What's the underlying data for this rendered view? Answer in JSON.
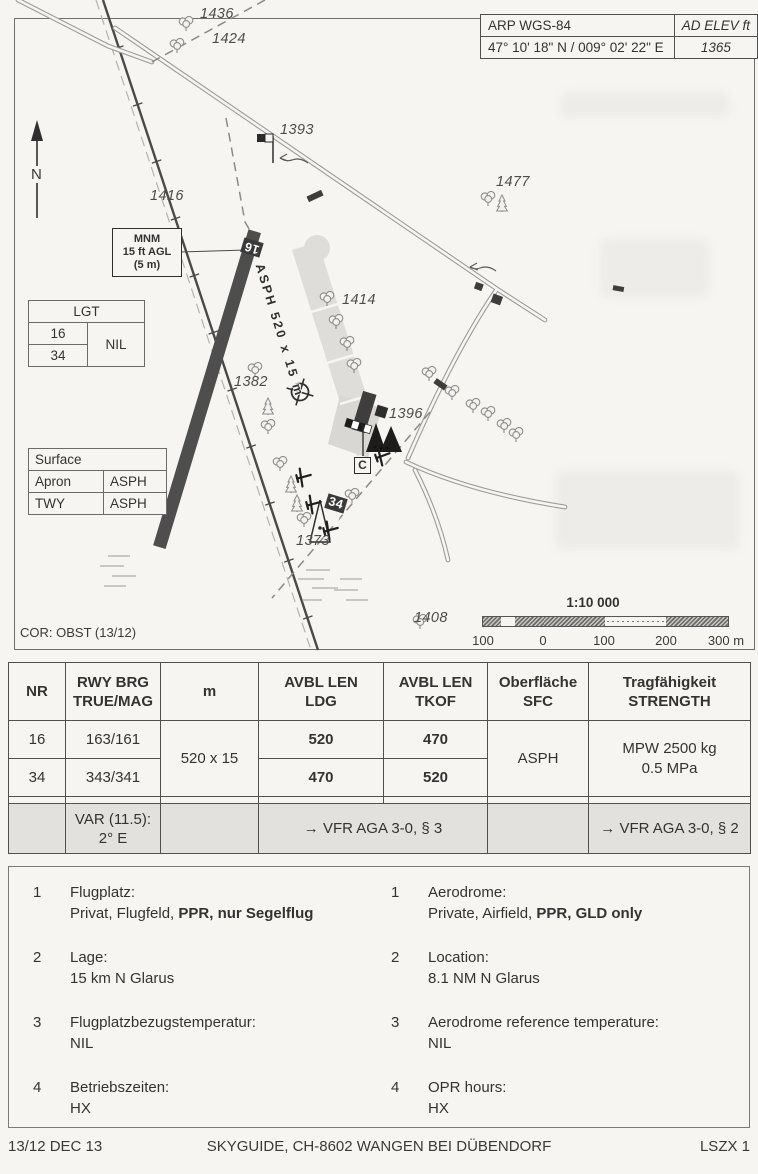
{
  "info_box": {
    "arp_label": "ARP WGS-84",
    "elev_label": "AD ELEV ft",
    "coords": "47° 10' 18\" N / 009° 02' 22\" E",
    "elev_value": "1365"
  },
  "map": {
    "north_label": "N",
    "mnm_box": {
      "line1": "MNM",
      "line2": "15 ft AGL",
      "line3": "(5 m)"
    },
    "lgt_table": {
      "header": "LGT",
      "row1": "16",
      "row2": "34",
      "value": "NIL"
    },
    "surface_table": {
      "header": "Surface",
      "rows": [
        {
          "label": "Apron",
          "value": "ASPH"
        },
        {
          "label": "TWY",
          "value": "ASPH"
        }
      ]
    },
    "runway": {
      "label_16": "16",
      "label_34": "34",
      "surface_label": "ASPH 520 x 15 m"
    },
    "spot_elevations": [
      "1436",
      "1424",
      "1393",
      "1477",
      "1416",
      "1414",
      "1382",
      "1396",
      "1373",
      "1408"
    ],
    "visitor_sign": "C",
    "cor_note": "COR: OBST (13/12)",
    "scale": {
      "title": "1:10 000",
      "ticks": [
        "100",
        "0",
        "100",
        "200",
        "300 m"
      ]
    }
  },
  "runway_table": {
    "headers": {
      "nr": "NR",
      "brg1": "RWY BRG",
      "brg2": "TRUE/MAG",
      "m": "m",
      "ldg1": "AVBL LEN",
      "ldg2": "LDG",
      "tkof1": "AVBL LEN",
      "tkof2": "TKOF",
      "sfc1": "Oberfläche",
      "sfc2": "SFC",
      "str1": "Tragfähigkeit",
      "str2": "STRENGTH"
    },
    "rows": [
      {
        "nr": "16",
        "brg": "163/161",
        "ldg": "520",
        "tkof": "470"
      },
      {
        "nr": "34",
        "brg": "343/341",
        "ldg": "470",
        "tkof": "520"
      }
    ],
    "dim": "520 x 15",
    "sfc": "ASPH",
    "strength1": "MPW 2500 kg",
    "strength2": "0.5 MPa",
    "var_row": {
      "var1": "VAR (11.5):",
      "var2": "2° E",
      "ref_len": "→ VFR AGA 3-0, § 3",
      "ref_strength": "→ VFR AGA 3-0, § 2"
    }
  },
  "remarks": {
    "de": [
      {
        "num": "1",
        "title": "Flugplatz:",
        "text": "Privat, Flugfeld, ",
        "bold": "PPR, nur Segelflug"
      },
      {
        "num": "2",
        "title": "Lage:",
        "text": "15 km N Glarus",
        "bold": ""
      },
      {
        "num": "3",
        "title": "Flugplatzbezugstemperatur:",
        "text": "NIL",
        "bold": ""
      },
      {
        "num": "4",
        "title": "Betriebszeiten:",
        "text": "HX",
        "bold": ""
      }
    ],
    "en": [
      {
        "num": "1",
        "title": "Aerodrome:",
        "text": "Private, Airfield, ",
        "bold": "PPR, GLD only"
      },
      {
        "num": "2",
        "title": "Location:",
        "text": "8.1 NM N Glarus",
        "bold": ""
      },
      {
        "num": "3",
        "title": "Aerodrome reference temperature:",
        "text": "NIL",
        "bold": ""
      },
      {
        "num": "4",
        "title": "OPR hours:",
        "text": "HX",
        "bold": ""
      }
    ]
  },
  "footer": {
    "date": "13/12 DEC 13",
    "publisher": "SKYGUIDE, CH-8602 WANGEN BEI DÜBENDORF",
    "page": "LSZX 1"
  }
}
